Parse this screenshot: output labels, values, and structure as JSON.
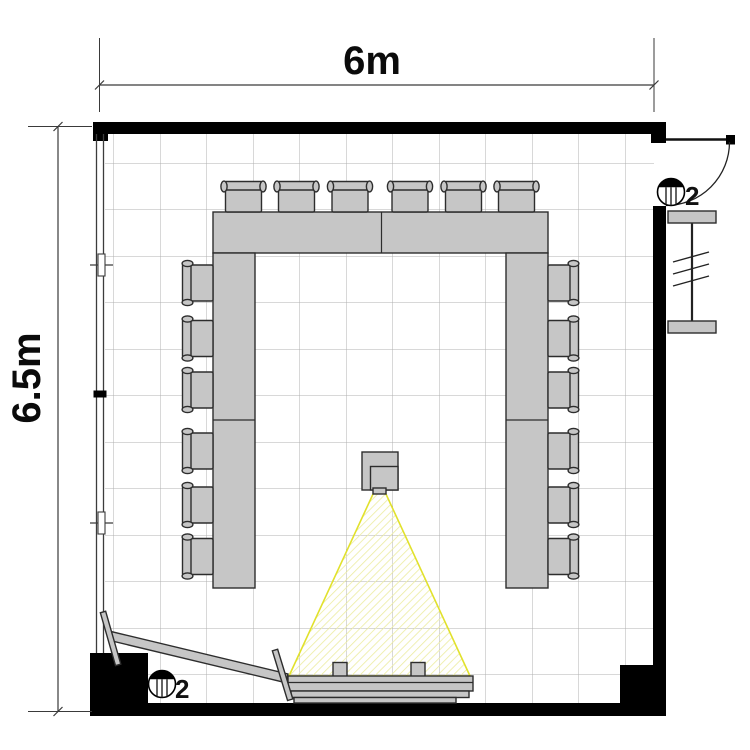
{
  "plan": {
    "type": "meeting-room-floor-plan",
    "dimensions": {
      "width": {
        "label": "6m"
      },
      "height": {
        "label": "6.5m"
      }
    },
    "symbols": {
      "door_outlet": {
        "icon": "ceiling-outlet-icon",
        "label": "2"
      },
      "corner_outlet": {
        "icon": "ceiling-outlet-icon",
        "label": "2"
      }
    },
    "furniture": {
      "table_layout": "u-shape",
      "table_segments": 6,
      "chairs_top": 6,
      "chairs_left": 6,
      "chairs_right": 6,
      "chairs_total": 18,
      "items": [
        "u-shaped-conference-table",
        "chairs",
        "ceiling-projector",
        "projection-beam",
        "projection-screen",
        "mobile-whiteboard",
        "radiator",
        "entrance-door",
        "window-wall"
      ]
    },
    "colors": {
      "background": "#ffffff",
      "wall": "#000000",
      "furniture_fill": "#c6c6c6",
      "furniture_stroke": "#2d2d2d",
      "grid_line": "#b0b0b0",
      "beam_edge": "#e1e12c",
      "beam_hatch": "#ececa0",
      "dimension_line": "#3a3a3a"
    }
  }
}
